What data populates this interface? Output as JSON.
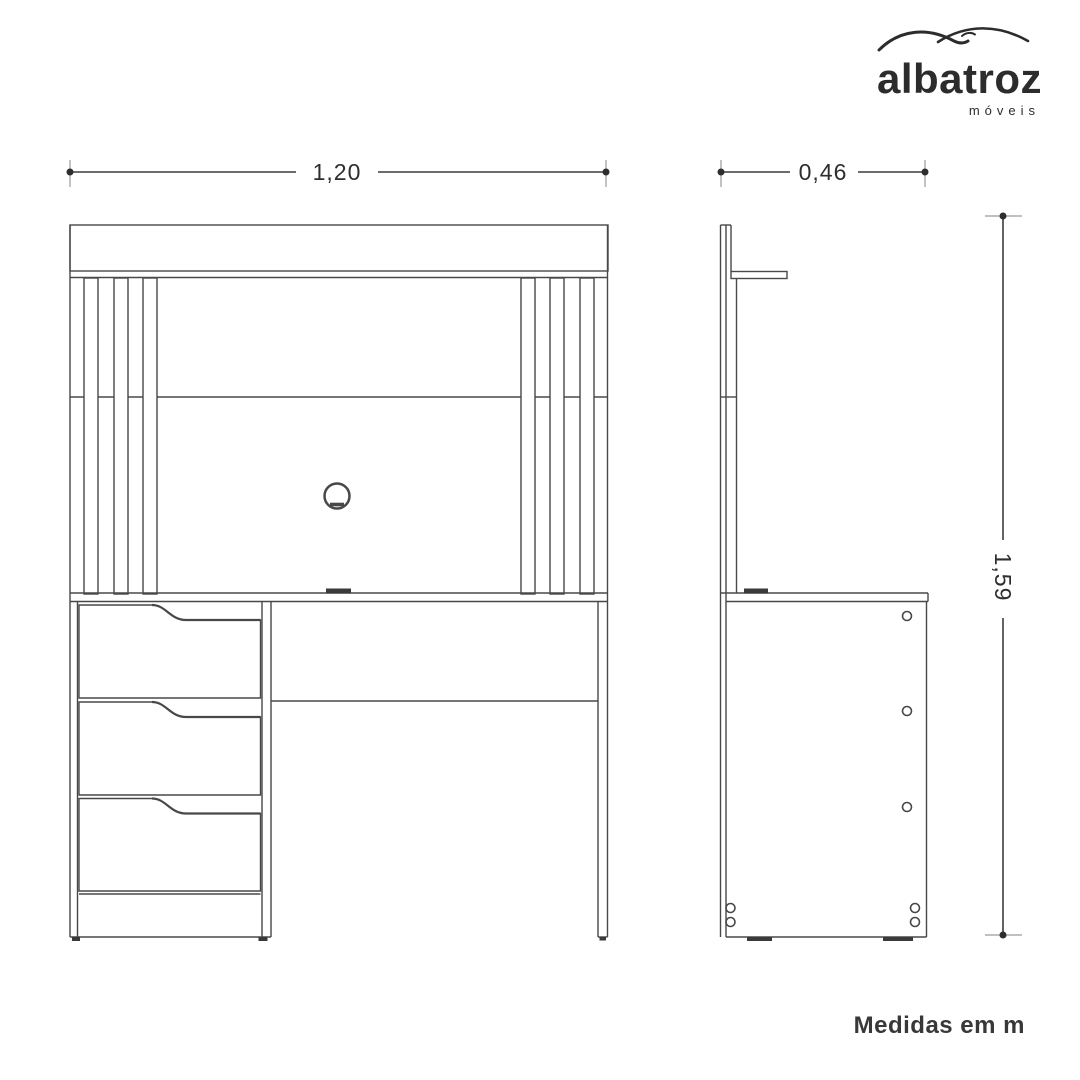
{
  "brand": {
    "name": "albatroz",
    "tagline": "móveis"
  },
  "dimensions": {
    "width": "1,20",
    "depth": "0,46",
    "height": "1,59"
  },
  "note": "Medidas em m",
  "colors": {
    "line": "#484848",
    "dimension": "#3c3c3c",
    "tick": "#9b9b9b",
    "text": "#2e2e2e",
    "background": "#ffffff"
  }
}
